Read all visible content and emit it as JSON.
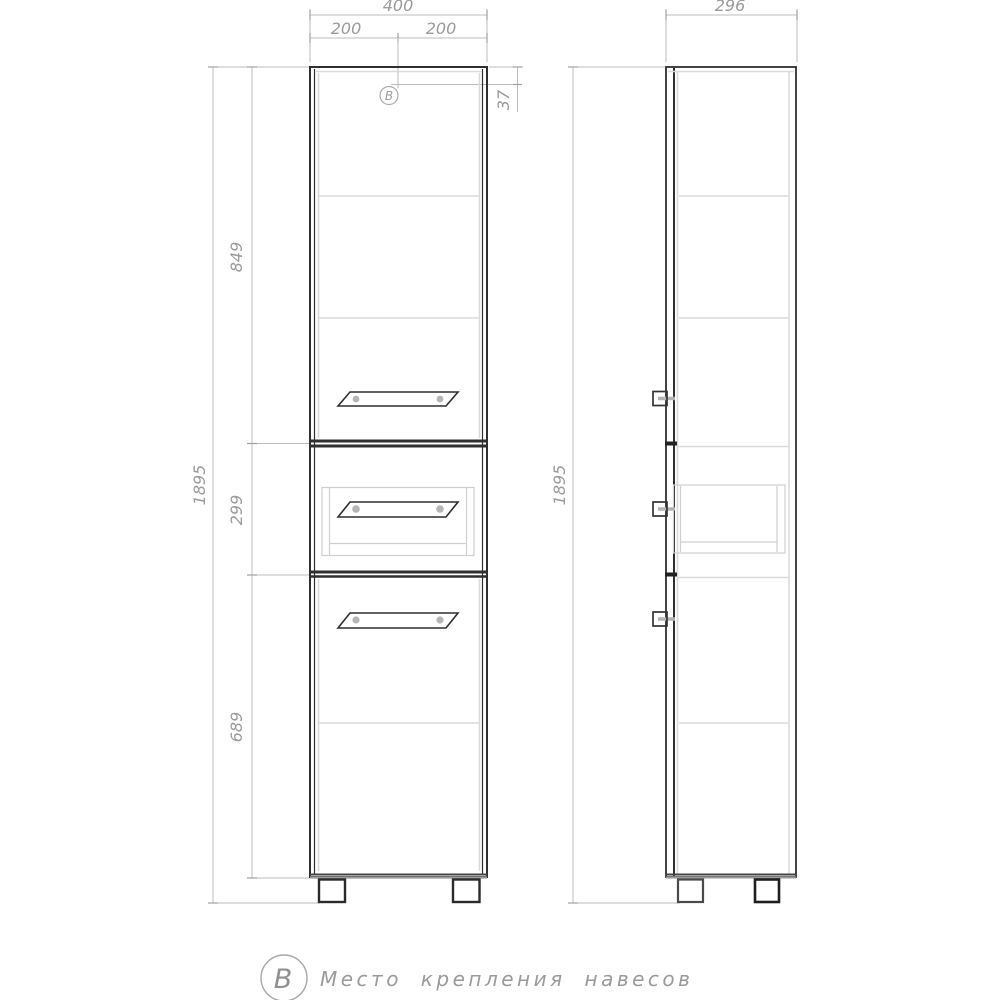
{
  "legend": {
    "symbol": "В",
    "label": "Место крепления навесов"
  },
  "front_view": {
    "marker_symbol": "В",
    "dimensions": {
      "total_width": "400",
      "left_half_width": "200",
      "right_half_width": "200",
      "hanger_offset_from_top": "37",
      "upper_door_height": "849",
      "drawer_section_height": "299",
      "lower_door_height": "689",
      "total_height": "1895"
    }
  },
  "side_view": {
    "dimensions": {
      "total_depth": "296",
      "total_height": "1895"
    }
  },
  "colors": {
    "outline_dark": "#2f2f2f",
    "dimension_line": "#bcbcbc",
    "dimension_text": "#9a9a9a",
    "panel_light": "#dadada",
    "screw_gray": "#b5b5b5"
  }
}
